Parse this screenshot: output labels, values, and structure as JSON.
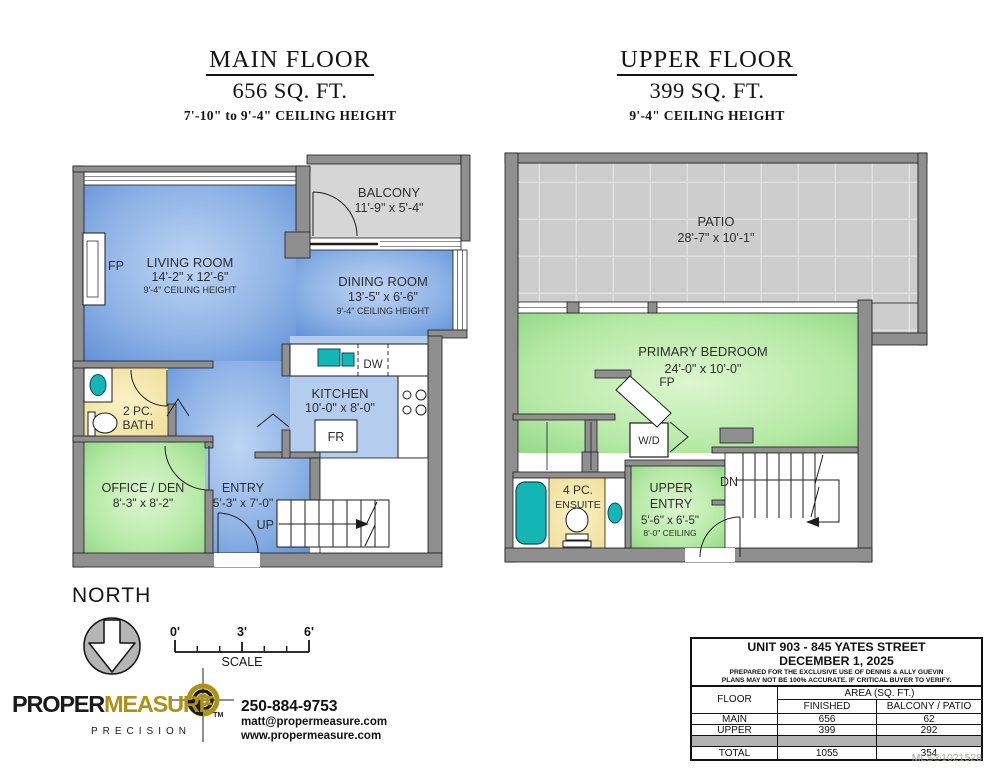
{
  "colors": {
    "wall_gray": "#8f8f8f",
    "room_blue": "#6f9bdc",
    "room_green": "#9ad88c",
    "bath_yellow": "#f0dfa0",
    "fixture_teal": "#14b5b5",
    "balcony_gray": "#d6d6d6",
    "patio_gray": "#cdcdcd",
    "logo_gold": "#ae9217"
  },
  "main_floor": {
    "title": "MAIN FLOOR",
    "area": "656 SQ. FT.",
    "ceiling": "7'-10\" to 9'-4\" CEILING HEIGHT",
    "balcony": {
      "name": "BALCONY",
      "dims": "11'-9\" x 5'-4\""
    },
    "living": {
      "name": "LIVING ROOM",
      "dims": "14'-2\" x 12'-6\"",
      "ceiling": "9'-4\" CEILING HEIGHT",
      "fp": "FP"
    },
    "dining": {
      "name": "DINING ROOM",
      "dims": "13'-5\" x 6'-6\"",
      "ceiling": "9'-4\" CEILING HEIGHT"
    },
    "kitchen": {
      "name": "KITCHEN",
      "dims": "10'-0\" x 8'-0\"",
      "dw": "DW",
      "fr": "FR"
    },
    "bath": {
      "line1": "2 PC.",
      "line2": "BATH"
    },
    "office": {
      "name": "OFFICE / DEN",
      "dims": "8'-3\" x 8'-2\""
    },
    "entry": {
      "name": "ENTRY",
      "dims": "5'-3\" x 7'-0\"",
      "up": "UP"
    }
  },
  "upper_floor": {
    "title": "UPPER FLOOR",
    "area": "399 SQ. FT.",
    "ceiling": "9'-4\" CEILING HEIGHT",
    "patio": {
      "name": "PATIO",
      "dims": "28'-7\" x 10'-1\""
    },
    "bedroom": {
      "name": "PRIMARY BEDROOM",
      "dims": "24'-0\" x 10'-0\"",
      "fp": "FP",
      "wd": "W/D"
    },
    "ensuite": {
      "line1": "4 PC.",
      "line2": "ENSUITE"
    },
    "entry": {
      "line1": "UPPER",
      "line2": "ENTRY",
      "dims": "5'-6\" x 6'-5\"",
      "ceiling": "8'-0\" CEILING",
      "dn": "DN"
    }
  },
  "compass": {
    "label": "NORTH"
  },
  "scale_bar": {
    "tick0": "0'",
    "tick3": "3'",
    "tick6": "6'",
    "label": "SCALE"
  },
  "logo": {
    "proper": "PROPER",
    "measure": "MEASURE",
    "tm": "TM",
    "precision": "PRECISION"
  },
  "contact": {
    "phone": "250-884-9753",
    "email": "matt@propermeasure.com",
    "website": "www.propermeasure.com"
  },
  "info_table": {
    "address": "UNIT 903 - 845 YATES STREET",
    "date": "DECEMBER 1, 2025",
    "disclaimer1": "PREPARED FOR THE EXCLUSIVE USE OF DENNIS & ALLY GUEVIN",
    "disclaimer2": "PLANS MAY NOT BE 100% ACCURATE. IF CRITICAL BUYER TO VERIFY.",
    "headers": {
      "floor": "FLOOR",
      "area": "AREA (SQ. FT.)",
      "finished": "FINISHED",
      "balcony": "BALCONY / PATIO"
    },
    "rows": [
      {
        "floor": "MAIN",
        "finished": "656",
        "balcony": "62"
      },
      {
        "floor": "UPPER",
        "finished": "399",
        "balcony": "292"
      }
    ],
    "total": {
      "floor": "TOTAL",
      "finished": "1055",
      "balcony": "354"
    }
  },
  "mls": "MLS®1021528"
}
